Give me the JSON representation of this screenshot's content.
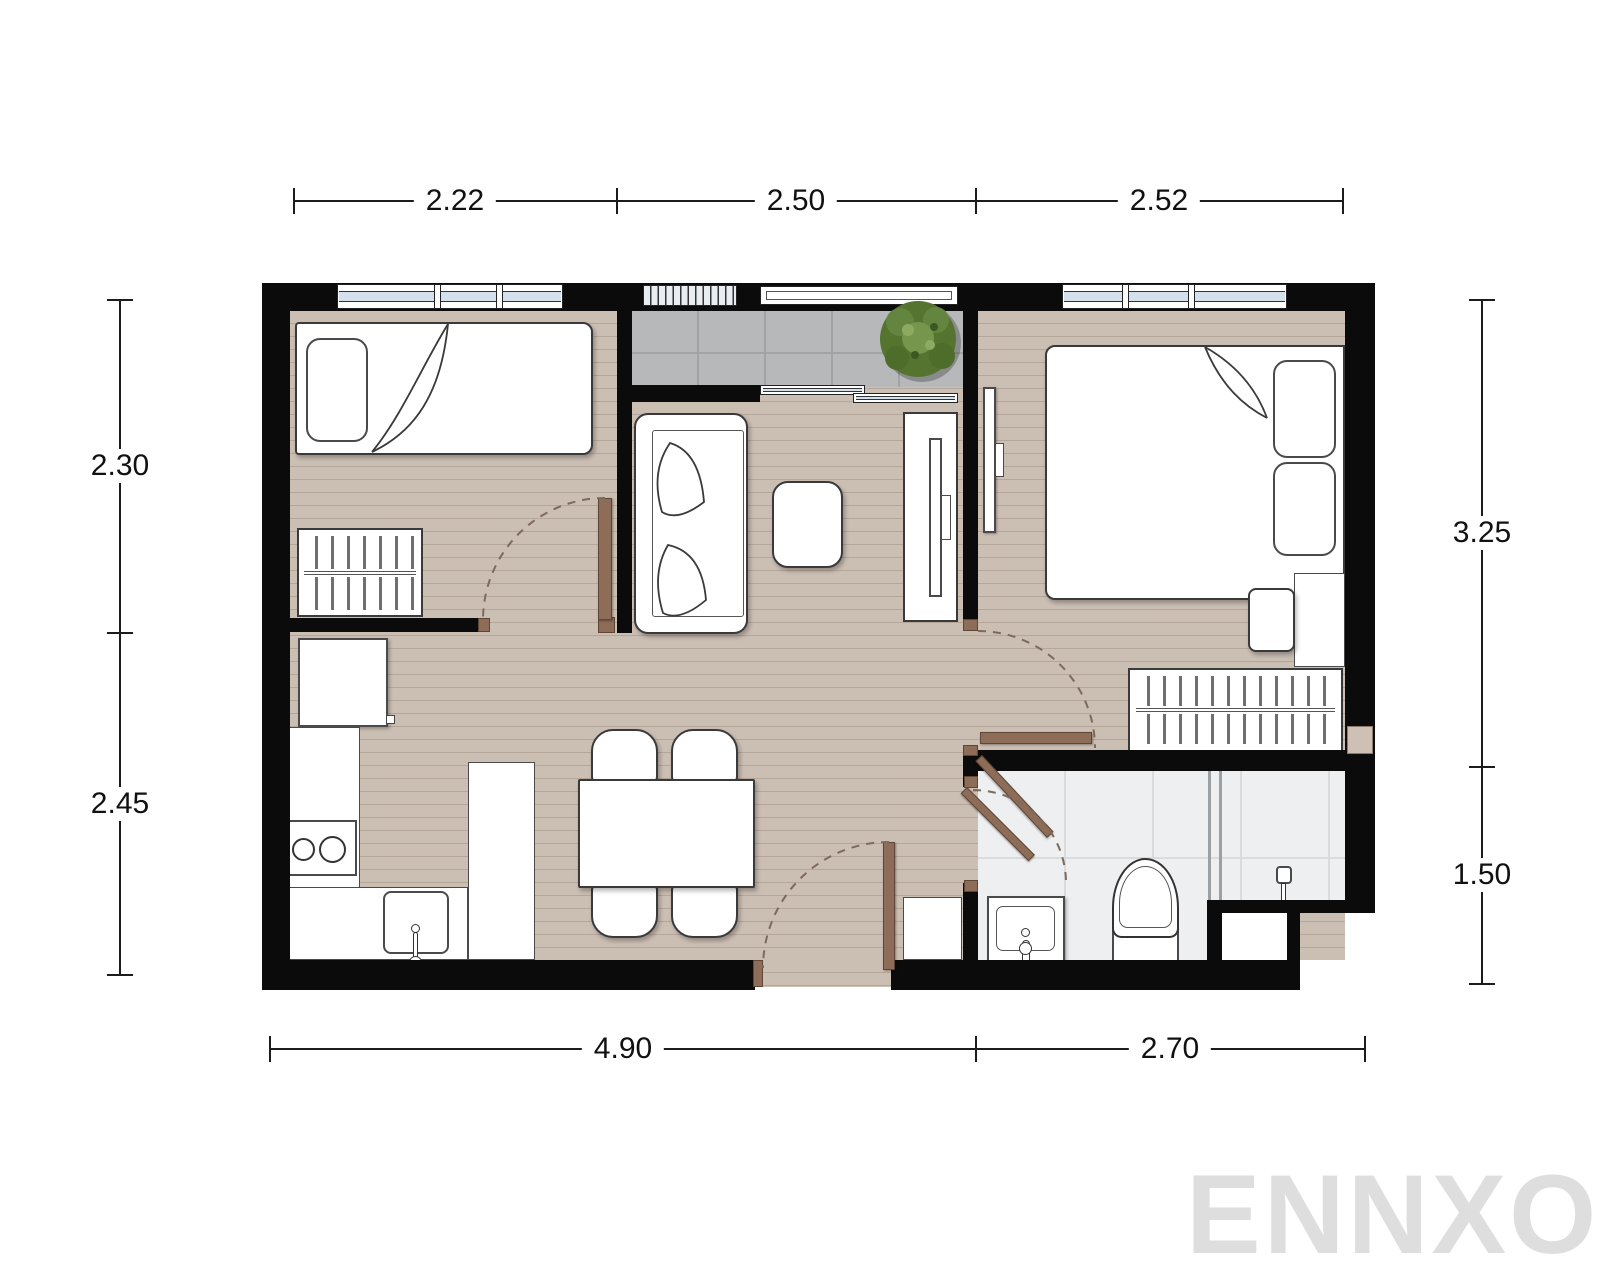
{
  "dimensions": {
    "top": [
      {
        "label": "2.22"
      },
      {
        "label": "2.50"
      },
      {
        "label": "2.52"
      }
    ],
    "bottom": [
      {
        "label": "4.90"
      },
      {
        "label": "2.70"
      }
    ],
    "left": [
      {
        "label": "2.30"
      },
      {
        "label": "2.45"
      }
    ],
    "right": [
      {
        "label": "3.25"
      },
      {
        "label": "1.50"
      }
    ]
  },
  "watermark": {
    "text": "ENNXO",
    "color": "#dedede"
  },
  "colors": {
    "wall": "#0b0b0b",
    "floor_wood": "#cbbeb3",
    "balcony_tile": "#b7b8ba",
    "bathroom_tile": "#edeff0",
    "door_leaf": "#8d6c58",
    "window_glass": "#d4e1ec",
    "plant_green": "#5d7f3a",
    "dimension_text": "#111111"
  }
}
